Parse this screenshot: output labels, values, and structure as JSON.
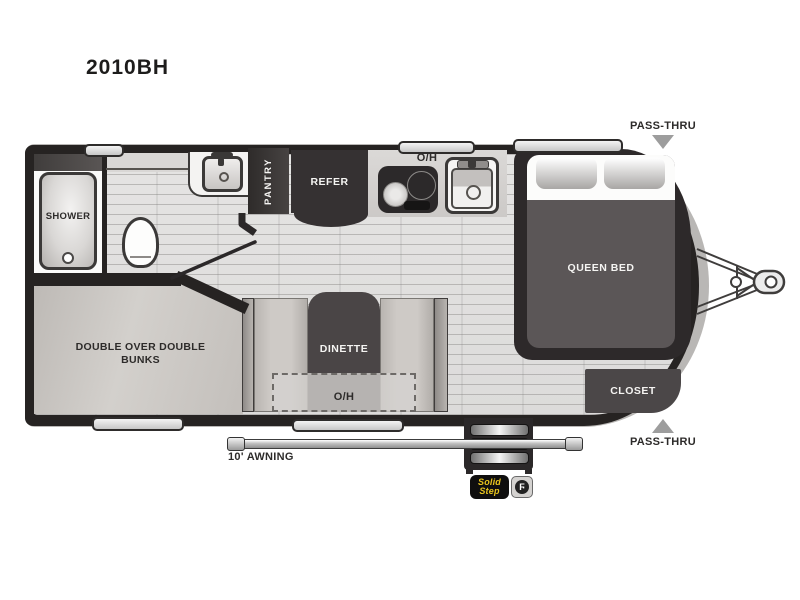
{
  "model": "2010BH",
  "labels": {
    "shower": "SHOWER",
    "pantry": "PANTRY",
    "refer": "REFER",
    "kitchen_overhead": "O/H",
    "queen_bed": "QUEEN BED",
    "pass_thru_top": "PASS-THRU",
    "pass_thru_bottom": "PASS-THRU",
    "closet": "CLOSET",
    "bunks_line1": "DOUBLE OVER DOUBLE",
    "bunks_line2": "BUNKS",
    "dinette": "DINETTE",
    "dinette_overhead": "O/H",
    "awning": "10' AWNING"
  },
  "badges": {
    "solid_step_line1": "Solid",
    "solid_step_line2": "Step"
  },
  "colors": {
    "wall_dark": "#262322",
    "block_dark": "#353132",
    "mattress_gray": "#5b5657",
    "floor_light": "#e0dfde",
    "bunk_gray": "#cbc7c3",
    "arrow_gray": "#9d9d9d",
    "solid_step_yellow": "#e8c41e"
  }
}
